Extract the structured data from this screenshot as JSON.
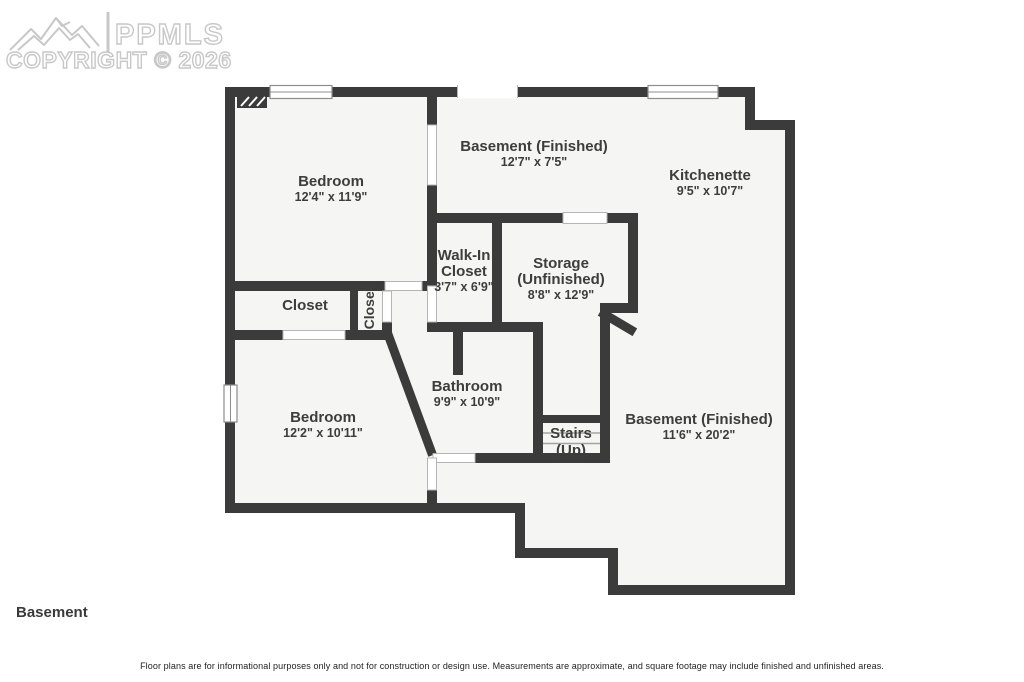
{
  "watermark": {
    "brand": "PPMLS",
    "copyright": "COPYRIGHT © 2026",
    "logo": "mountain-logo",
    "color": "#c8c8c8"
  },
  "floor_label": "Basement",
  "disclaimer": "Floor plans are for informational purposes only and not for construction or design use. Measurements are approximate, and square footage may include finished and unfinished areas.",
  "rooms": [
    {
      "id": "bedroom-1",
      "name": "Bedroom",
      "dims": "12'4\" x 11'9\""
    },
    {
      "id": "basement-finished-1",
      "name": "Basement (Finished)",
      "dims": "12'7\" x 7'5\""
    },
    {
      "id": "kitchenette",
      "name": "Kitchenette",
      "dims": "9'5\" x 10'7\""
    },
    {
      "id": "walk-in-closet",
      "name": "Walk-In Closet",
      "dims": "3'7\" x 6'9\""
    },
    {
      "id": "storage-unfinished",
      "name": "Storage (Unfinished)",
      "dims": "8'8\" x 12'9\""
    },
    {
      "id": "closet-1",
      "name": "Closet",
      "dims": ""
    },
    {
      "id": "closet-2",
      "name": "Closet",
      "dims": ""
    },
    {
      "id": "bathroom",
      "name": "Bathroom",
      "dims": "9'9\" x 10'9\""
    },
    {
      "id": "bedroom-2",
      "name": "Bedroom",
      "dims": "12'2\" x 10'11\""
    },
    {
      "id": "stairs",
      "name": "Stairs",
      "dims": "(Up)"
    },
    {
      "id": "basement-finished-2",
      "name": "Basement (Finished)",
      "dims": "11'6\" x 20'2\""
    }
  ],
  "colors": {
    "wall": "#3b3b3b",
    "floor": "#f5f5f3",
    "text": "#3d3d3d",
    "opening_line": "#b5b5b5"
  }
}
